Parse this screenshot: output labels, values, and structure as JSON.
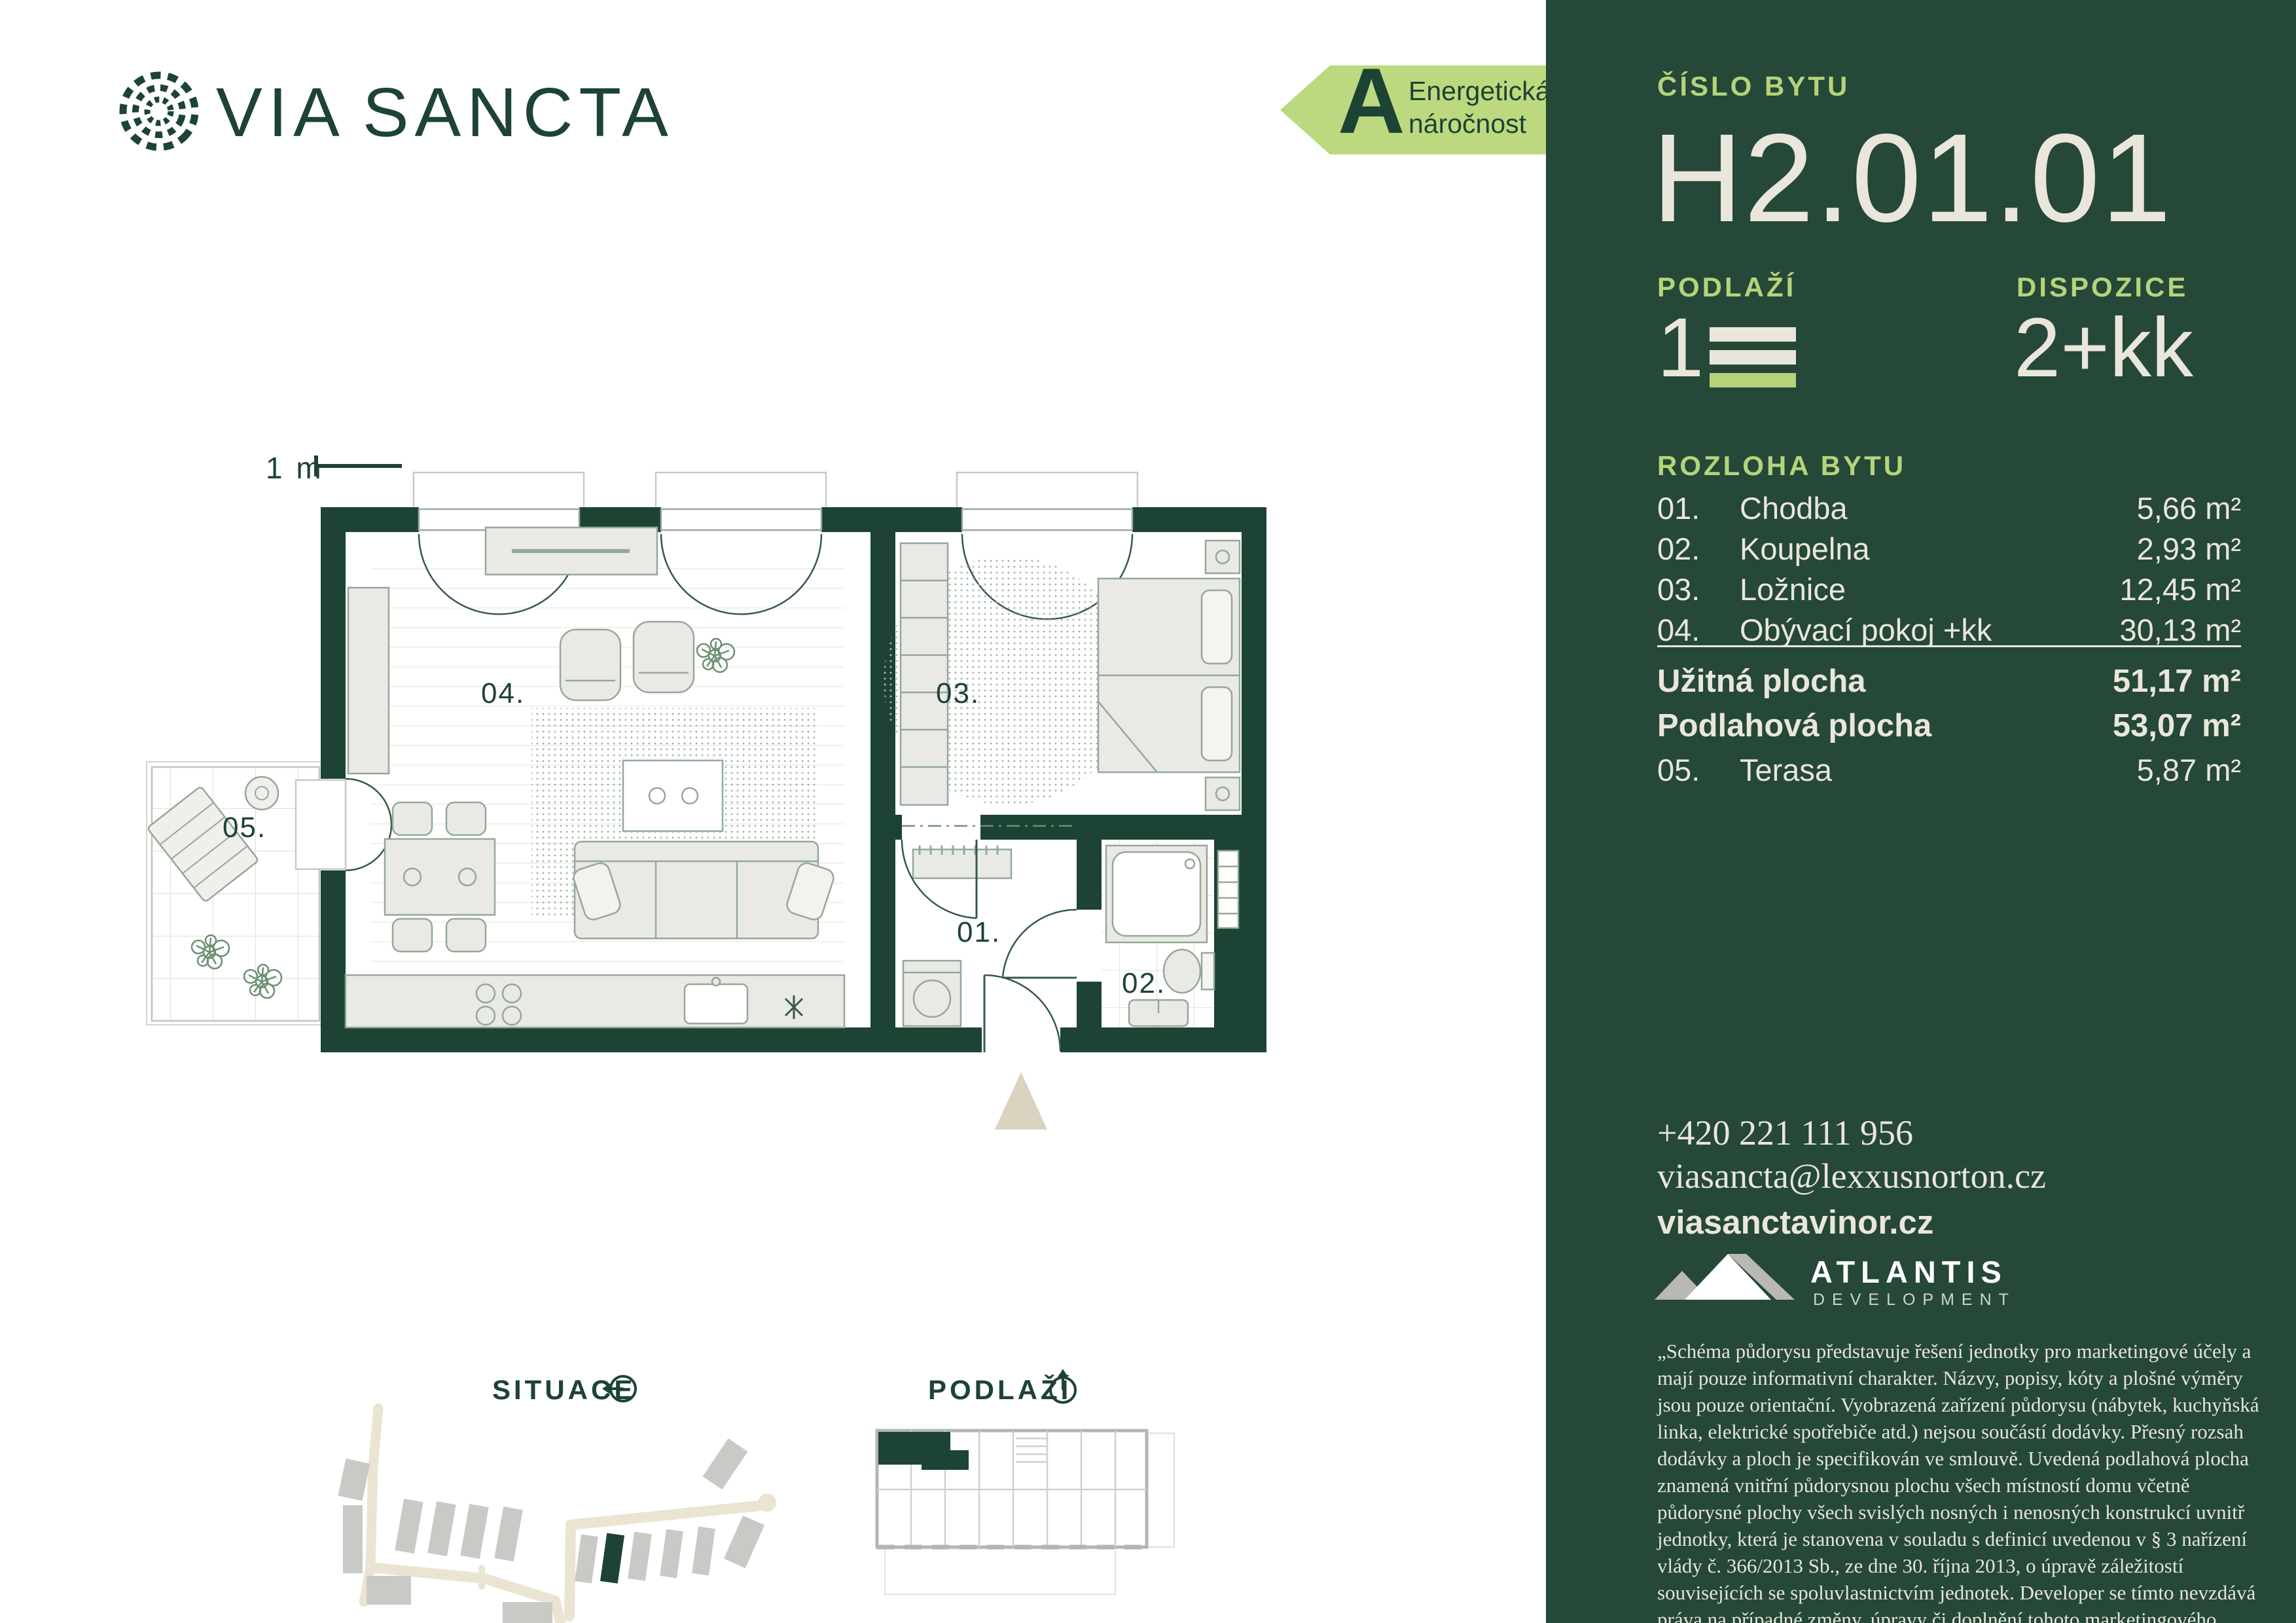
{
  "colors": {
    "ink_green": "#1d4334",
    "sidebar_bg": "#254838",
    "accent_light_green": "#b5d37b",
    "cream_text": "#eae6db",
    "badge_bg": "#bcd97f",
    "road_beige": "#ece4d3",
    "building_gray": "#c9c9c6",
    "entrance_triangle": "#d9d3c0"
  },
  "brand": {
    "via": "VIA",
    "sancta": "SANCTA"
  },
  "energy": {
    "grade": "A",
    "line1": "Energetická",
    "line2": "náročnost"
  },
  "plan": {
    "scale_label": "1 m",
    "labels": {
      "r01": "01.",
      "r02": "02.",
      "r03": "03.",
      "r04": "04.",
      "r05": "05."
    }
  },
  "captions": {
    "situace": "SITUACE",
    "podlazi": "PODLAŽÍ"
  },
  "sb": {
    "unit_label": "ČÍSLO BYTU",
    "unit_number": "H2.01.01",
    "floor_label": "PODLAŽÍ",
    "floor_value": "1",
    "layout_label": "DISPOZICE",
    "layout_value": "2+kk",
    "areas_label": "ROZLOHA BYTU",
    "rooms": [
      {
        "num": "01.",
        "name": "Chodba",
        "area": "5,66 m²"
      },
      {
        "num": "02.",
        "name": "Koupelna",
        "area": "2,93 m²"
      },
      {
        "num": "03.",
        "name": "Ložnice",
        "area": "12,45 m²"
      },
      {
        "num": "04.",
        "name": "Obývací pokoj +kk",
        "area": "30,13 m²"
      }
    ],
    "totals": [
      {
        "name": "Užitná plocha",
        "area": "51,17 m²"
      },
      {
        "name": "Podlahová plocha",
        "area": "53,07 m²"
      }
    ],
    "terrace": {
      "num": "05.",
      "name": "Terasa",
      "area": "5,87 m²"
    },
    "contact": {
      "phone": "+420 221 111 956",
      "email": "viasancta@lexxusnorton.cz",
      "web": "viasanctavinor.cz"
    },
    "developer": {
      "name": "ATLANTIS",
      "sub": "DEVELOPMENT"
    },
    "disclaimer": "„Schéma půdorysu představuje řešení jednotky pro marketingové účely a mají pouze informativní charakter. Názvy, popisy, kóty a plošné výměry jsou pouze orientační. Vyobrazená zařízení půdorysu (nábytek, kuchyňská linka, elektrické spotřebiče atd.) nejsou součástí dodávky. Přesný rozsah dodávky a ploch je specifikován ve smlouvě. Uvedená podlahová plocha znamená vnitřní půdorysnou plochu všech místností domu včetně půdorysné plochy všech svislých nosných i nenosných konstrukcí uvnitř jednotky, která je stanovena v souladu s definicí uvedenou v § 3 nařízení vlády č. 366/2013 Sb., ze dne 30. října 2013, o úpravě záležitostí souvisejících se spoluvlastnictvím jednotek. Developer se tímto nevzdává práva na případné změny, úpravy či doplnění tohoto marketingového materiálu.“"
  }
}
